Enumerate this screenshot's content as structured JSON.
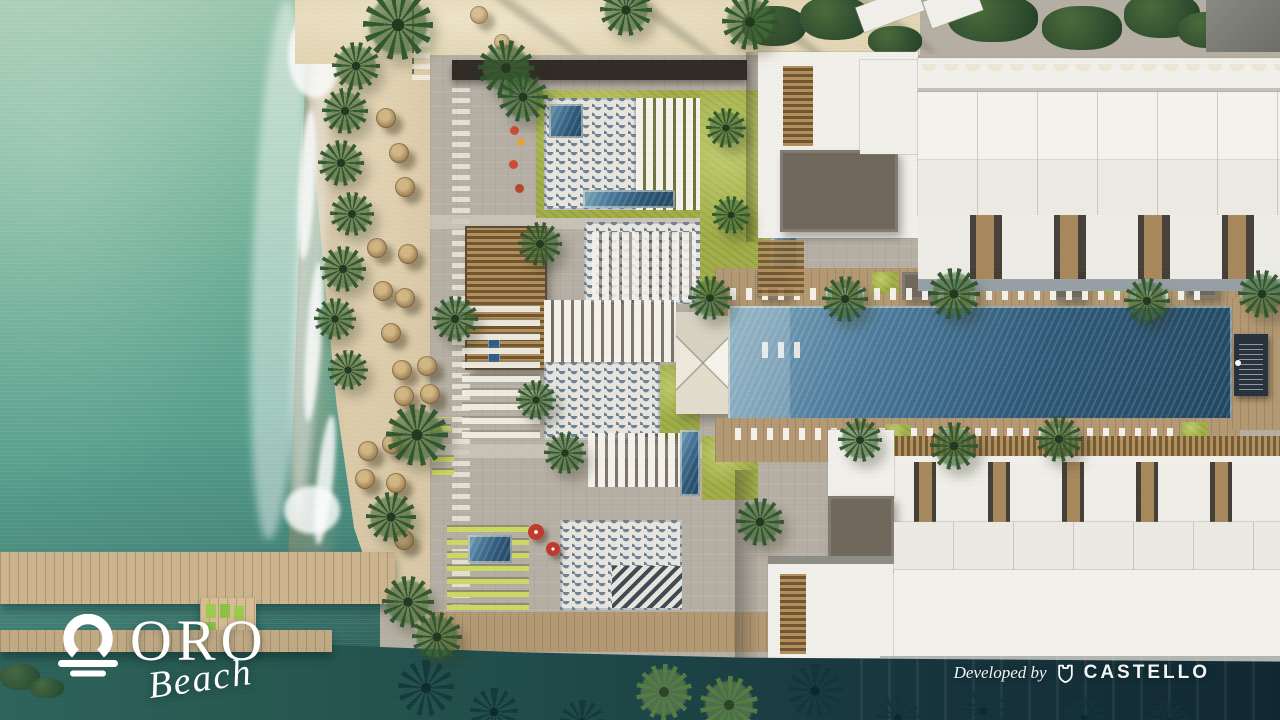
{
  "branding": {
    "logo": {
      "icon": "oro-sun-waves-icon",
      "title": "ORO",
      "subtitle": "Beach"
    },
    "developer": {
      "label": "Developed by",
      "icon": "castello-shield-icon",
      "name": "CASTELLO"
    }
  },
  "scene": {
    "type": "aerial-architectural-render",
    "features": [
      "sea",
      "shoreline-foam",
      "sand-beach",
      "palm-trees",
      "thatch-umbrellas",
      "beach-club-decks",
      "wave-mosaic-paving",
      "pergolas",
      "swimming-pools",
      "sun-loungers",
      "white-canopy-tent",
      "residential-buildings",
      "wooden-piers",
      "lagoon-water"
    ]
  },
  "palette": {
    "sea_light": "#A6CCB3",
    "sea_deep": "#346B63",
    "sand": "#D9C8A4",
    "sand_light": "#E4D6B4",
    "pool_shallow": "#7FA9BD",
    "pool_deep": "#1F4560",
    "lawn": "#A2AF48",
    "pavement": "#B6AFA4",
    "deck_wood": "#B49A74",
    "pier_wood": "#CDB58F",
    "roof_white": "#F3F1EC",
    "roof_taupe": "#6F675C",
    "canopy_dark": "#2F2B24",
    "lagoon_dark": "#0F2730",
    "text": "#FFFFFF"
  }
}
